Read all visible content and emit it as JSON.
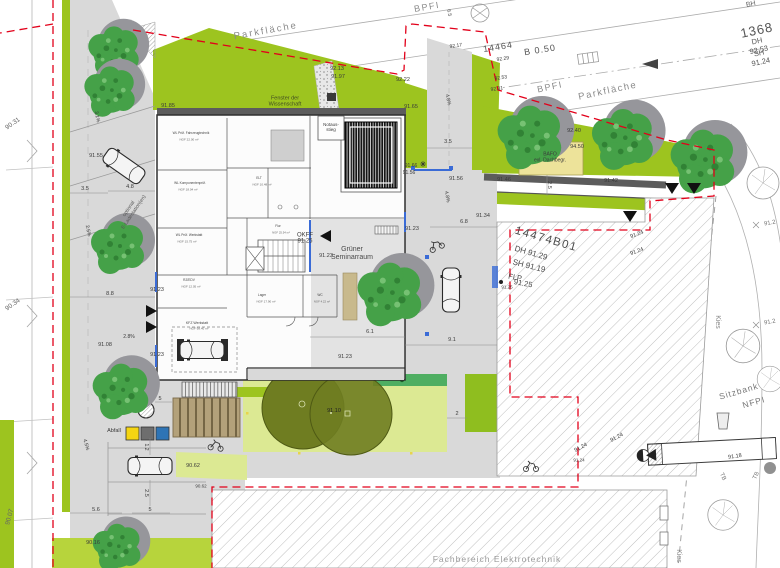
{
  "plan": {
    "kind": "architectural site plan",
    "existing_building_label": "Fachbereich Elektrotechnik",
    "parcel_numbers": [
      "14474B01",
      "14464"
    ],
    "street_number": "1368"
  },
  "colors": {
    "boundary_red": "#E2001A",
    "lawn_green": "#9DC41F",
    "pale_green": "#DCE993",
    "lime_green": "#B7D43C",
    "hedge_green": "#4FAE62",
    "canopy_olive": "#6F7D21",
    "roof_yellow": "#EDE39A",
    "shelter_tan": "#B3A17A",
    "facade_blue": "#3A6BD6",
    "pavement_grey": "#D9D9D9",
    "wall_grey": "#5C5C5C",
    "bin_yellow": "#F5D512",
    "bin_grey": "#6E6E6E",
    "bin_blue": "#2E74B5"
  },
  "labels": [
    {
      "id": "parkflaeche-1",
      "t": "Parkfläche",
      "x": 266,
      "y": 32,
      "fs": 9.5,
      "rot": -10,
      "c": "#8A8A8A",
      "ls": 2
    },
    {
      "id": "bpfi-1",
      "t": "BPFI",
      "x": 427,
      "y": 7,
      "fs": 9,
      "rot": -10,
      "c": "#8A8A8A",
      "ls": 1.5
    },
    {
      "id": "dim-6-5",
      "t": "6.5",
      "x": 448,
      "y": 13,
      "fs": 5,
      "rot": 78
    },
    {
      "id": "bh-label",
      "t": "BH",
      "x": 751,
      "y": 5,
      "fs": 7,
      "rot": -12,
      "c": "#666666"
    },
    {
      "id": "num-1368",
      "t": "1368",
      "x": 757,
      "y": 31,
      "fs": 13,
      "rot": -12,
      "c": "#555555",
      "ls": 1
    },
    {
      "id": "dh-92-53",
      "t": "DH 92.53",
      "x": 758,
      "y": 46,
      "fs": 7.5,
      "rot": -12,
      "c": "#555555"
    },
    {
      "id": "sh-91-24",
      "t": "SH 91.24",
      "x": 760,
      "y": 58,
      "fs": 7.5,
      "rot": -12,
      "c": "#555555"
    },
    {
      "id": "num-14464",
      "t": "14464",
      "x": 498,
      "y": 47,
      "fs": 9,
      "rot": -9,
      "c": "#555555",
      "ls": 1
    },
    {
      "id": "b-0-50",
      "t": "B 0.50",
      "x": 540,
      "y": 50,
      "fs": 9,
      "rot": -9,
      "c": "#555555",
      "ls": 1
    },
    {
      "id": "num-92-13",
      "t": "92.13",
      "x": 337,
      "y": 69,
      "fs": 5.5
    },
    {
      "id": "num-91-97",
      "t": "91.97",
      "x": 338,
      "y": 77,
      "fs": 5.5
    },
    {
      "id": "num-92-22",
      "t": "92.22",
      "x": 403,
      "y": 80,
      "fs": 5.5
    },
    {
      "id": "num-92-17",
      "t": "92.17",
      "x": 456,
      "y": 47,
      "fs": 5,
      "rot": -8
    },
    {
      "id": "num-92-29",
      "t": "92.29",
      "x": 503,
      "y": 60,
      "fs": 5,
      "rot": -8
    },
    {
      "id": "num-92-53b",
      "t": "92.53",
      "x": 501,
      "y": 79,
      "fs": 5,
      "rot": -8
    },
    {
      "id": "num-92-31",
      "t": "92.31",
      "x": 497,
      "y": 90,
      "fs": 5,
      "rot": -8
    },
    {
      "id": "bpfi-2",
      "t": "BPFI",
      "x": 550,
      "y": 87,
      "fs": 9,
      "rot": -12,
      "c": "#8A8A8A",
      "ls": 1.5
    },
    {
      "id": "parkflaeche-2",
      "t": "Parkfläche",
      "x": 608,
      "y": 92,
      "fs": 9.5,
      "rot": -12,
      "c": "#8A8A8A",
      "ls": 1.5
    },
    {
      "id": "fenster-label",
      "t": "Fenster der\nWissenschaft",
      "x": 285,
      "y": 102,
      "fs": 5.5,
      "c": "#3F4A22"
    },
    {
      "id": "notausstieg-label",
      "t": "Notaus-\nstieg",
      "x": 331,
      "y": 127,
      "fs": 4.5
    },
    {
      "id": "num-91-85",
      "t": "91.85",
      "x": 168,
      "y": 106,
      "fs": 5.5
    },
    {
      "id": "num-91-65",
      "t": "91.65",
      "x": 411,
      "y": 107,
      "fs": 5.5
    },
    {
      "id": "num-92-40",
      "t": "92.40",
      "x": 574,
      "y": 131,
      "fs": 5.5
    },
    {
      "id": "num-94-50",
      "t": "94.50",
      "x": 577,
      "y": 147,
      "fs": 5.5
    },
    {
      "id": "bafo-label",
      "t": "BAFO\nexl. Dachbegr.",
      "x": 550,
      "y": 158,
      "fs": 5
    },
    {
      "id": "num-91-66",
      "t": "91.66",
      "x": 411,
      "y": 167,
      "fs": 5
    },
    {
      "id": "num-91-56a",
      "t": "91.56",
      "x": 409,
      "y": 174,
      "fs": 5
    },
    {
      "id": "num-91-56b",
      "t": "91.56",
      "x": 456,
      "y": 179,
      "fs": 5.5
    },
    {
      "id": "num-91-46",
      "t": "91.46",
      "x": 504,
      "y": 180,
      "fs": 5.5
    },
    {
      "id": "num-91-42",
      "t": "91.42",
      "x": 611,
      "y": 181,
      "fs": 5.5
    },
    {
      "id": "dim-3-5a",
      "t": "3.5",
      "x": 448,
      "y": 142,
      "fs": 5.5
    },
    {
      "id": "dim-2-5a",
      "t": "2.5",
      "x": 549,
      "y": 185,
      "fs": 5.5,
      "rot": 90
    },
    {
      "id": "slope-4-8a",
      "t": "4.8%",
      "x": 447,
      "y": 100,
      "fs": 5,
      "rot": 78
    },
    {
      "id": "slope-4-8b",
      "t": "4.8%",
      "x": 446,
      "y": 197,
      "fs": 5,
      "rot": 80
    },
    {
      "id": "dim-6-8",
      "t": "6.8",
      "x": 464,
      "y": 222,
      "fs": 5.5
    },
    {
      "id": "num-91-34",
      "t": "91.34",
      "x": 483,
      "y": 216,
      "fs": 5.5
    },
    {
      "id": "num-91-23a",
      "t": "91.23",
      "x": 412,
      "y": 229,
      "fs": 5.5
    },
    {
      "id": "num-14474",
      "t": "14474B01",
      "x": 546,
      "y": 240,
      "fs": 11.5,
      "rot": 16,
      "c": "#4A4A4A",
      "ls": 1.5
    },
    {
      "id": "dh-91-29",
      "t": "DH 91.29",
      "x": 531,
      "y": 253,
      "fs": 8,
      "rot": 16,
      "c": "#4A4A4A"
    },
    {
      "id": "sh-91-19",
      "t": "SH 91.19",
      "x": 529,
      "y": 266,
      "fs": 8,
      "rot": 14,
      "c": "#4A4A4A"
    },
    {
      "id": "flp-label",
      "t": "FLP",
      "x": 515,
      "y": 278,
      "fs": 7.5,
      "rot": 10,
      "c": "#4A4A4A"
    },
    {
      "id": "num-91-25b",
      "t": "91.25",
      "x": 523,
      "y": 284,
      "fs": 7.5,
      "rot": 10,
      "c": "#4A4A4A"
    },
    {
      "id": "num-91-25c",
      "t": "91.25",
      "x": 507,
      "y": 287,
      "fs": 4.5
    },
    {
      "id": "num-91-24a",
      "t": "91.24",
      "x": 637,
      "y": 235,
      "fs": 5.5,
      "rot": -20
    },
    {
      "id": "num-91-24b",
      "t": "91.24",
      "x": 637,
      "y": 252,
      "fs": 5.5,
      "rot": -20
    },
    {
      "id": "okff-label",
      "t": "OKFF",
      "x": 305,
      "y": 236,
      "fs": 6
    },
    {
      "id": "num-91-25a",
      "t": "91.25",
      "x": 305,
      "y": 242,
      "fs": 6
    },
    {
      "id": "num-91-23b",
      "t": "91.23",
      "x": 326,
      "y": 256,
      "fs": 5.5
    },
    {
      "id": "gruener-label",
      "t": "Grüner\nSeminarraum",
      "x": 352,
      "y": 254,
      "fs": 7,
      "c": "#4A4A4A"
    },
    {
      "id": "num-91-23c",
      "t": "91.23",
      "x": 157,
      "y": 290,
      "fs": 5.5
    },
    {
      "id": "num-91-23d",
      "t": "91.23",
      "x": 157,
      "y": 355,
      "fs": 5.5
    },
    {
      "id": "num-91-23e",
      "t": "91.23",
      "x": 345,
      "y": 357,
      "fs": 5.5
    },
    {
      "id": "dim-6-1",
      "t": "6.1",
      "x": 370,
      "y": 332,
      "fs": 5.5
    },
    {
      "id": "dim-9-1",
      "t": "9.1",
      "x": 452,
      "y": 340,
      "fs": 5.5
    },
    {
      "id": "num-90-31",
      "t": "90.31",
      "x": 13,
      "y": 124,
      "fs": 6.5,
      "rot": -35,
      "c": "#666666"
    },
    {
      "id": "num-91-55",
      "t": "91.55",
      "x": 96,
      "y": 156,
      "fs": 5.5
    },
    {
      "id": "dim-3-5b",
      "t": "3.5",
      "x": 85,
      "y": 189,
      "fs": 5.5
    },
    {
      "id": "dim-4-8",
      "t": "4.8",
      "x": 130,
      "y": 187,
      "fs": 5.5
    },
    {
      "id": "slope-3-1",
      "t": "3.1%",
      "x": 96,
      "y": 117,
      "fs": 5,
      "rot": 78
    },
    {
      "id": "e-lade-label",
      "t": "optional\nE-Ladestation(en)",
      "x": 132,
      "y": 211,
      "fs": 5,
      "rot": -56,
      "c": "#555555"
    },
    {
      "id": "slope-2-5",
      "t": "2.5%",
      "x": 87,
      "y": 231,
      "fs": 5,
      "rot": 78
    },
    {
      "id": "num-90-34",
      "t": "90.34",
      "x": 13,
      "y": 305,
      "fs": 6.5,
      "rot": -35,
      "c": "#666666"
    },
    {
      "id": "dim-8-8",
      "t": "8.8",
      "x": 110,
      "y": 294,
      "fs": 5.5
    },
    {
      "id": "num-91-08",
      "t": "91.08",
      "x": 105,
      "y": 345,
      "fs": 5.5
    },
    {
      "id": "slope-2-8",
      "t": "2.8%",
      "x": 129,
      "y": 338,
      "fs": 5
    },
    {
      "id": "dim-5a",
      "t": "5",
      "x": 160,
      "y": 399,
      "fs": 5.5
    },
    {
      "id": "slope-4-5",
      "t": "4.5%",
      "x": 85,
      "y": 445,
      "fs": 5,
      "rot": 75
    },
    {
      "id": "abfall-label",
      "t": "Abfall",
      "x": 114,
      "y": 431,
      "fs": 5.5
    },
    {
      "id": "dim-1-2",
      "t": "1.2",
      "x": 145,
      "y": 447,
      "fs": 5,
      "rot": 90
    },
    {
      "id": "num-90-62a",
      "t": "90.62",
      "x": 193,
      "y": 466,
      "fs": 5.5
    },
    {
      "id": "num-90-62b",
      "t": "90.62",
      "x": 201,
      "y": 486,
      "fs": 4.5
    },
    {
      "id": "dim-2-5b",
      "t": "2.5",
      "x": 146,
      "y": 493,
      "fs": 5.5,
      "rot": 90
    },
    {
      "id": "dim-5-6",
      "t": "5.6",
      "x": 96,
      "y": 510,
      "fs": 5.5
    },
    {
      "id": "dim-5b",
      "t": "5",
      "x": 150,
      "y": 510,
      "fs": 5.5
    },
    {
      "id": "num-90-07",
      "t": "90.07",
      "x": 10,
      "y": 517,
      "fs": 6.5,
      "rot": -75,
      "c": "#666666"
    },
    {
      "id": "num-90-16",
      "t": "90.16",
      "x": 93,
      "y": 543,
      "fs": 5.5
    },
    {
      "id": "num-91-10",
      "t": "91.10",
      "x": 334,
      "y": 411,
      "fs": 5.5,
      "c": "#222222"
    },
    {
      "id": "dim-2",
      "t": "2",
      "x": 457,
      "y": 414,
      "fs": 5.5
    },
    {
      "id": "fachbereich-label",
      "t": "Fachbereich Elektrotechnik",
      "x": 497,
      "y": 560,
      "fs": 8.5,
      "c": "#9A9A9A",
      "ls": 1
    },
    {
      "id": "kies-1",
      "t": "Kies",
      "x": 717,
      "y": 322,
      "fs": 7,
      "rot": 90,
      "c": "#8A8A8A"
    },
    {
      "id": "kies-2",
      "t": "Kies",
      "x": 678,
      "y": 556,
      "fs": 7,
      "rot": 90,
      "c": "#8A8A8A"
    },
    {
      "id": "sitzbank-label",
      "t": "Sitzbank",
      "x": 739,
      "y": 392,
      "fs": 8.5,
      "rot": -16,
      "c": "#777777",
      "ls": 1
    },
    {
      "id": "nfpi-label",
      "t": "NFPI",
      "x": 754,
      "y": 403,
      "fs": 8.5,
      "rot": -16,
      "c": "#777777",
      "ls": 1
    },
    {
      "id": "num-91-18",
      "t": "91.18",
      "x": 735,
      "y": 457,
      "fs": 5.5,
      "rot": -8
    },
    {
      "id": "num-91-24c",
      "t": "91.24",
      "x": 617,
      "y": 438,
      "fs": 5.5,
      "rot": -28
    },
    {
      "id": "num-91-24d",
      "t": "91.24",
      "x": 581,
      "y": 448,
      "fs": 5.5,
      "rot": -28
    },
    {
      "id": "num-91-24e",
      "t": "91.24",
      "x": 579,
      "y": 460,
      "fs": 4.5
    },
    {
      "id": "tb-1",
      "t": "TB",
      "x": 722,
      "y": 477,
      "fs": 6,
      "rot": 65,
      "c": "#777777"
    },
    {
      "id": "tb-2",
      "t": "TB",
      "x": 757,
      "y": 476,
      "fs": 6,
      "rot": -65,
      "c": "#777777"
    },
    {
      "id": "num-91-2a",
      "t": "91.2",
      "x": 770,
      "y": 224,
      "fs": 6,
      "rot": -10,
      "c": "#777777"
    },
    {
      "id": "num-91-2b",
      "t": "91.2",
      "x": 770,
      "y": 323,
      "fs": 6,
      "rot": -10,
      "c": "#777777"
    },
    {
      "id": "room-wl1",
      "t": "WL Prüf. Fahrzeugtechnik",
      "x": 191,
      "y": 134,
      "fs": 3.2,
      "c": "#444444"
    },
    {
      "id": "room-wl1-a",
      "t": "NGF 22.00 m²",
      "x": 189,
      "y": 140,
      "fs": 3,
      "c": "#666666"
    },
    {
      "id": "room-wl2",
      "t": "WL Komponentenprüf.",
      "x": 190,
      "y": 184,
      "fs": 3.2,
      "c": "#444444"
    },
    {
      "id": "room-wl2-a",
      "t": "NGF 18.04 m²",
      "x": 188,
      "y": 190,
      "fs": 3,
      "c": "#666666"
    },
    {
      "id": "room-wl3",
      "t": "WL Prüf. Werkstatt",
      "x": 189,
      "y": 236,
      "fs": 3.2,
      "c": "#444444"
    },
    {
      "id": "room-wl3-a",
      "t": "NGF 15.75 m²",
      "x": 187,
      "y": 242,
      "fs": 3,
      "c": "#666666"
    },
    {
      "id": "room-elt",
      "t": "ELT",
      "x": 259,
      "y": 179,
      "fs": 3.2,
      "c": "#444444"
    },
    {
      "id": "room-elt-a",
      "t": "NGF 10.48 m²",
      "x": 262,
      "y": 185,
      "fs": 3,
      "c": "#666666"
    },
    {
      "id": "room-flur",
      "t": "Flur",
      "x": 278,
      "y": 227,
      "fs": 3.2,
      "c": "#444444"
    },
    {
      "id": "room-flur-a",
      "t": "NGF 25.54 m²",
      "x": 281,
      "y": 233,
      "fs": 2.8,
      "c": "#666666"
    },
    {
      "id": "room-rz",
      "t": "RZ/EDV",
      "x": 189,
      "y": 281,
      "fs": 3.2,
      "c": "#444444"
    },
    {
      "id": "room-rz-a",
      "t": "NGF 12.05 m²",
      "x": 191,
      "y": 287,
      "fs": 3,
      "c": "#666666"
    },
    {
      "id": "room-lager",
      "t": "Lager",
      "x": 262,
      "y": 296,
      "fs": 3.2,
      "c": "#444444"
    },
    {
      "id": "room-lager-a",
      "t": "NGF 17.90 m²",
      "x": 266,
      "y": 302,
      "fs": 3,
      "c": "#666666"
    },
    {
      "id": "room-wc",
      "t": "WC",
      "x": 320,
      "y": 296,
      "fs": 3.2,
      "c": "#444444"
    },
    {
      "id": "room-wc-a",
      "t": "NGF 4.22 m²",
      "x": 322,
      "y": 302,
      "fs": 2.8,
      "c": "#666666"
    },
    {
      "id": "room-kfz",
      "t": "KFZ Werkstatt",
      "x": 197,
      "y": 323,
      "fs": 3.5,
      "c": "#444444"
    },
    {
      "id": "room-kfz-a",
      "t": "NGF 98.40 m²",
      "x": 199,
      "y": 329,
      "fs": 3,
      "c": "#666666"
    }
  ]
}
